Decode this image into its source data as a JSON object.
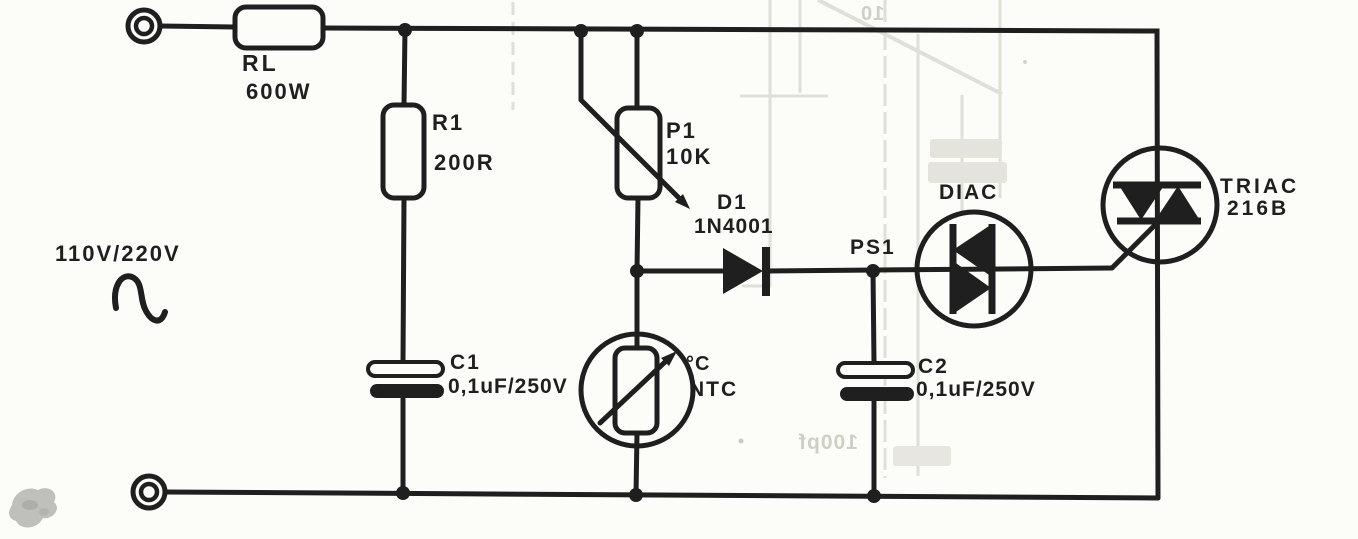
{
  "diagram_type": "circuit-schematic",
  "schematic": {
    "power_source": {
      "label": "110V/220V",
      "symbol": "ac-sine-wave"
    },
    "components": {
      "rl": {
        "ref": "RL",
        "value": "600W"
      },
      "r1": {
        "ref": "R1",
        "value": "200R"
      },
      "c1": {
        "ref": "C1",
        "value": "0,1uF/250V"
      },
      "p1": {
        "ref": "P1",
        "value": "10K"
      },
      "d1": {
        "ref": "D1",
        "value": "1N4001"
      },
      "ntc": {
        "ref": "NTC",
        "temp_marking": "°C"
      },
      "ps1": {
        "ref": "PS1"
      },
      "diac": {
        "ref": "DIAC"
      },
      "c2": {
        "ref": "C2",
        "value": "0,1uF/250V"
      },
      "triac": {
        "ref": "TRIAC",
        "value": "216B"
      }
    },
    "bleed_through_text": {
      "top": "10",
      "bottom": "100pf"
    }
  },
  "colors": {
    "ink": "#1f1f1f",
    "paper": "#fcfcf9",
    "bleed_gray": "#d7d7cf"
  }
}
